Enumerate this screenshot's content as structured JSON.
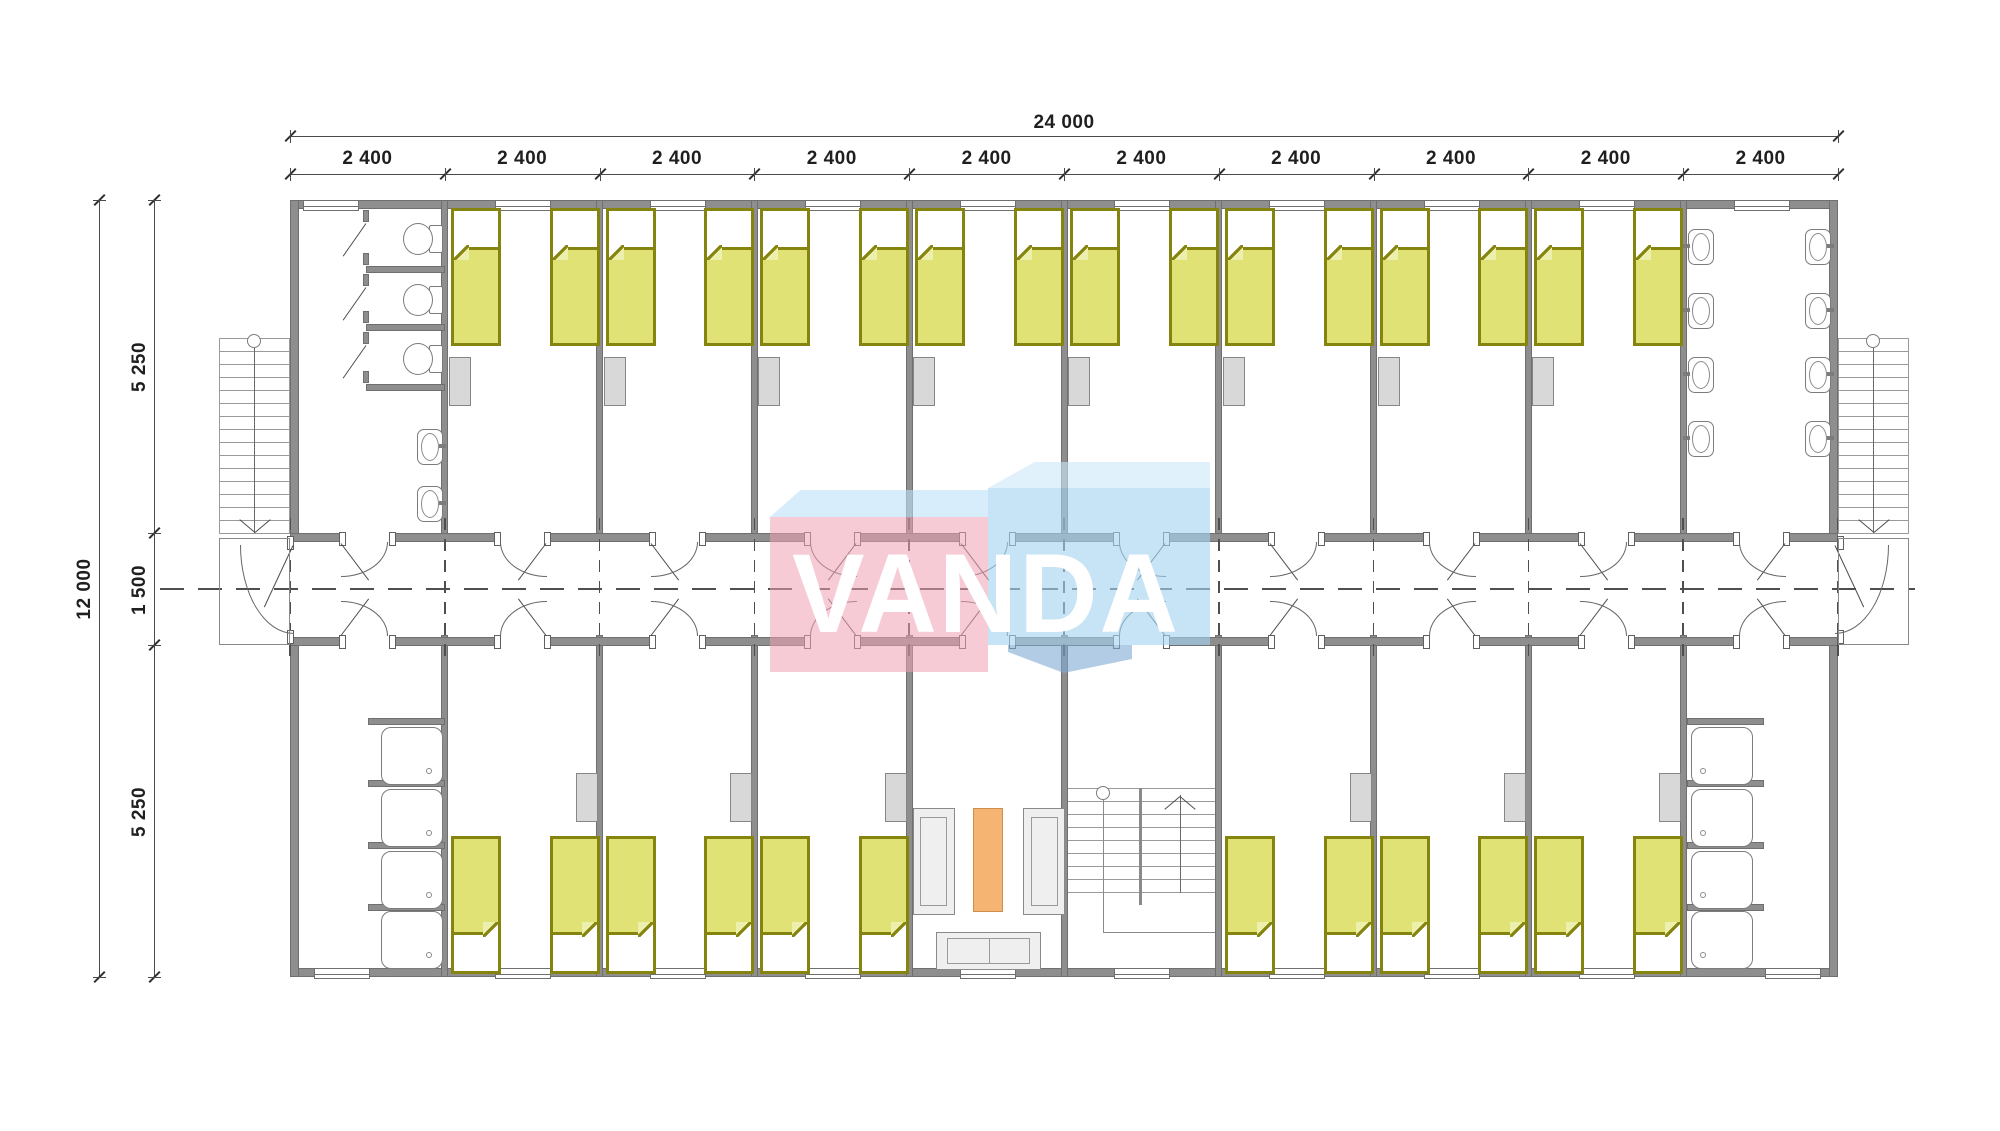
{
  "drawing": {
    "type": "architectural floor plan",
    "subject": "modular dormitory building, 10 modules of 2 400 mm"
  },
  "dimensions": {
    "top_total": "24 000",
    "top_segments": [
      "2 400",
      "2 400",
      "2 400",
      "2 400",
      "2 400",
      "2 400",
      "2 400",
      "2 400",
      "2 400",
      "2 400"
    ],
    "left_total": "12 000",
    "left_top": "5 250",
    "left_middle": "1 500",
    "left_bottom": "5 250"
  },
  "watermark": {
    "text": "VANDA",
    "pink": "rgba(238,160,178,0.55)",
    "pink_top": "rgba(190,225,248,0.6)",
    "blue_front": "rgba(165,210,240,0.62)",
    "blue_top": "rgba(205,232,250,0.6)",
    "blue_dark": "rgba(125,170,210,0.6)"
  },
  "palette": {
    "wall": "#8e8e8e",
    "wall_outline": "#6f6f6f",
    "bed_fill": "#e0e275",
    "bed_border": "#85840f",
    "bed_fold_tint": "#edefac",
    "furniture_gray": "#d8d8d8",
    "fixture_line": "#7c7c7c",
    "table_orange": "#f6b472",
    "table_orange_border": "#cf8f4a",
    "dimension_text": "#1f1f1f",
    "centerline": "#4f4f4f"
  },
  "rooms": {
    "top": [
      {
        "type": "toilet-room",
        "stalls": 3,
        "toilets": 3,
        "basins": 2
      },
      {
        "type": "bedroom",
        "beds": 2,
        "wardrobes": 1
      },
      {
        "type": "bedroom",
        "beds": 2,
        "wardrobes": 1
      },
      {
        "type": "bedroom",
        "beds": 2,
        "wardrobes": 1
      },
      {
        "type": "bedroom",
        "beds": 2,
        "wardrobes": 1
      },
      {
        "type": "bedroom",
        "beds": 2,
        "wardrobes": 1
      },
      {
        "type": "bedroom",
        "beds": 2,
        "wardrobes": 1
      },
      {
        "type": "bedroom",
        "beds": 2,
        "wardrobes": 1
      },
      {
        "type": "bedroom",
        "beds": 2,
        "wardrobes": 1
      },
      {
        "type": "washroom",
        "basins": 8
      }
    ],
    "bottom": [
      {
        "type": "shower-room",
        "showers": 4
      },
      {
        "type": "bedroom",
        "beds": 2,
        "wardrobes": 1
      },
      {
        "type": "bedroom",
        "beds": 2,
        "wardrobes": 1
      },
      {
        "type": "bedroom",
        "beds": 2,
        "wardrobes": 1
      },
      {
        "type": "lounge",
        "sofas": 3,
        "tables": 1
      },
      {
        "type": "stairwell"
      },
      {
        "type": "bedroom",
        "beds": 2,
        "wardrobes": 1
      },
      {
        "type": "bedroom",
        "beds": 2,
        "wardrobes": 1
      },
      {
        "type": "bedroom",
        "beds": 2,
        "wardrobes": 1
      },
      {
        "type": "shower-room",
        "showers": 4
      }
    ]
  }
}
